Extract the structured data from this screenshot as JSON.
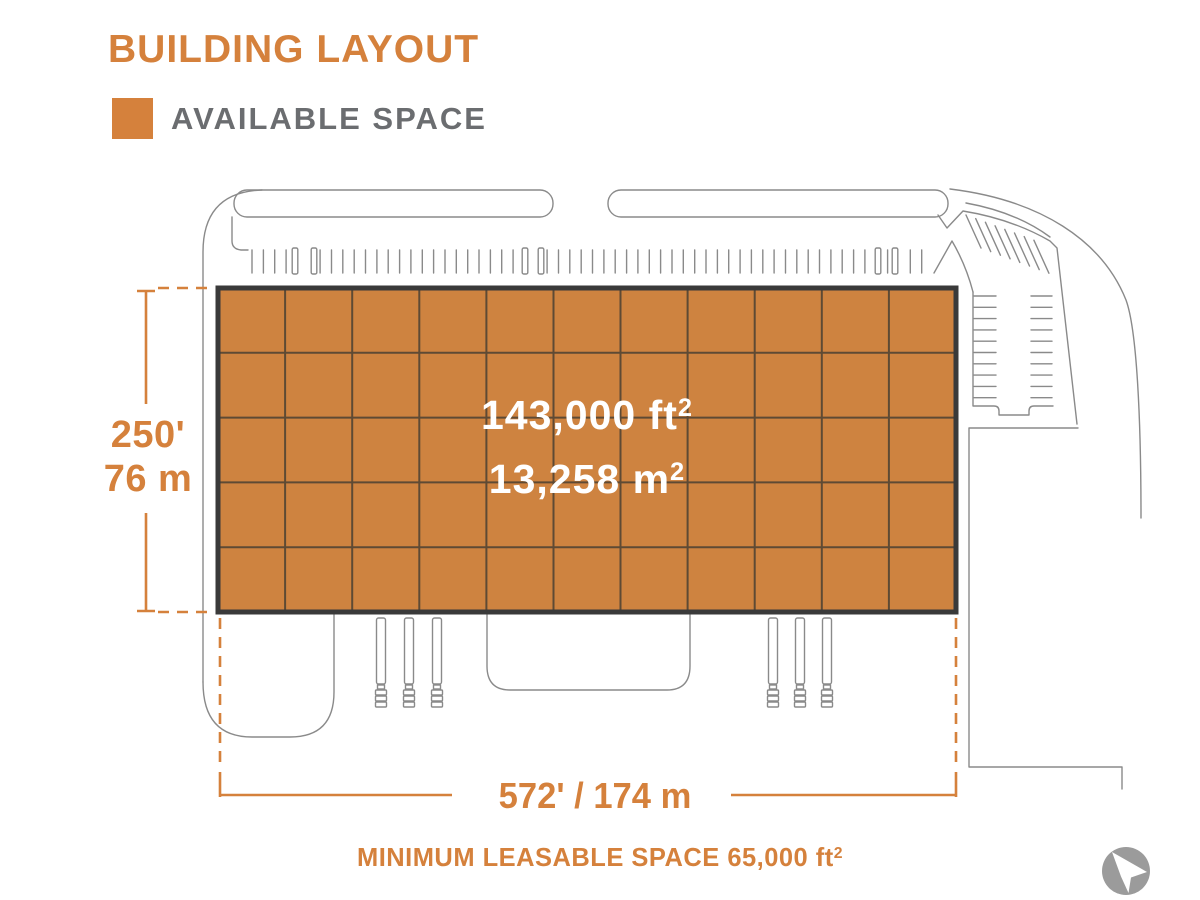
{
  "title": "BUILDING LAYOUT",
  "legend": {
    "label": "AVAILABLE SPACE"
  },
  "building": {
    "area_ft": "143,000 ft",
    "area_ft_exp": "2",
    "area_m": "13,258 m",
    "area_m_exp": "2",
    "grid_columns": 11,
    "grid_rows": 5
  },
  "dimensions": {
    "depth_ft": "250'",
    "depth_m": "76 m",
    "width": "572' / 174 m"
  },
  "footer": {
    "text": "MINIMUM LEASABLE SPACE 65,000 ft",
    "exp": "2"
  },
  "colors": {
    "accent": "#D5813C",
    "label_gray": "#6B6D70",
    "plan_line": "#8A8A8A",
    "building_fill": "#CE8340",
    "building_outline": "#3A3A3A",
    "grid_line": "#5E4A34",
    "area_text": "#FFFFFF",
    "logo_gray": "#9B9B9B"
  }
}
